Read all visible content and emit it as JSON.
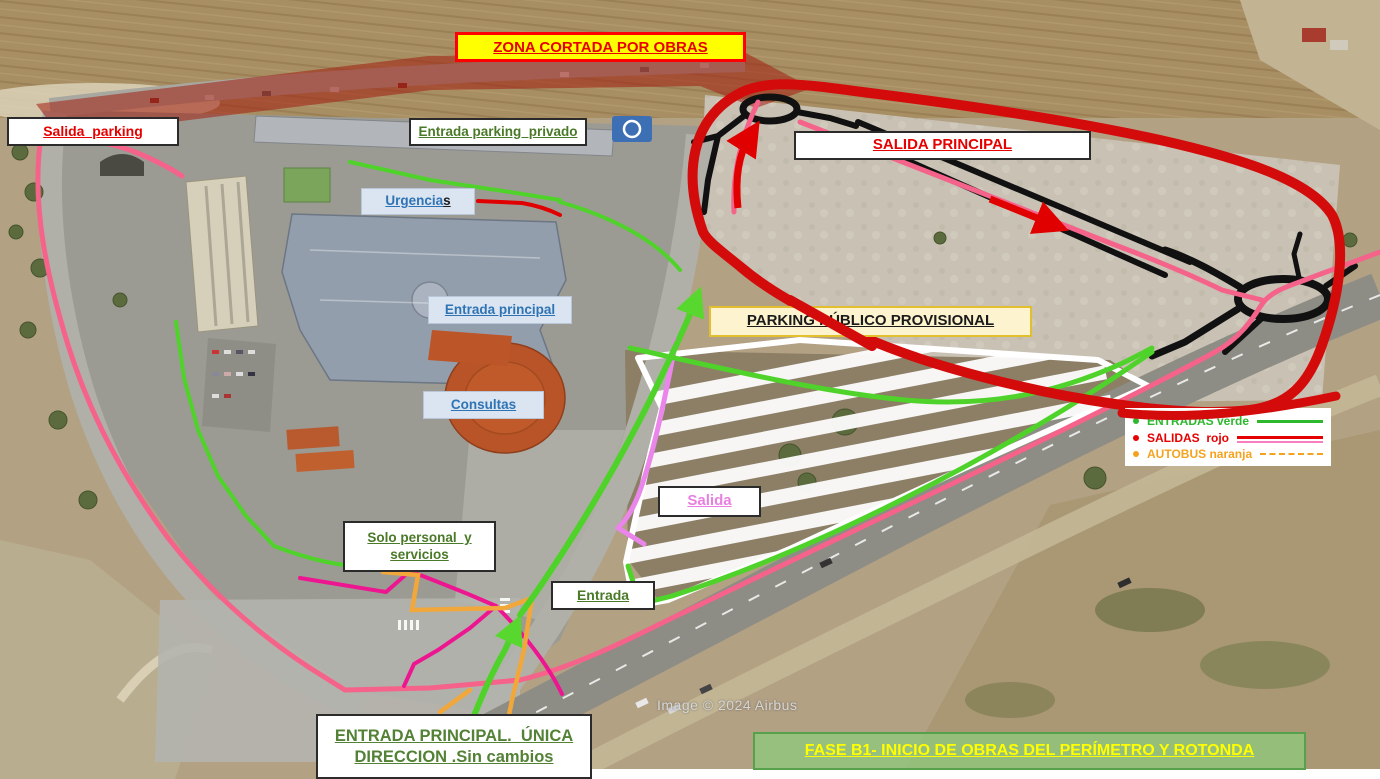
{
  "banners": {
    "zona_cortada": "ZONA CORTADA POR OBRAS",
    "fase_b1": "FASE B1- INICIO DE OBRAS DEL PERÍMETRO Y ROTONDA"
  },
  "labels": {
    "salida_parking": "Salida  parking",
    "entrada_parking_privado": "Entrada parking  privado",
    "urgencias_main": "Urgencia",
    "urgencias_suffix": "s",
    "salida_principal": "SALIDA PRINCIPAL",
    "entrada_principal": "Entrada principal",
    "parking_publico_provisional": "PARKING PÚBLICO PROVISIONAL",
    "consultas": "Consultas",
    "salida_provisional": "Salida",
    "solo_personal_line1": "Solo personal  y",
    "solo_personal_line2": "servicios",
    "entrada_provisional": "Entrada",
    "entrada_principal_unica_line1": "ENTRADA PRINCIPAL.  ÚNICA",
    "entrada_principal_unica_line2": "DIRECCION .Sin cambios"
  },
  "legend": {
    "items": [
      {
        "label": "ENTRADAS verde",
        "color": "#2eb82e",
        "line_style": "solid"
      },
      {
        "label": "SALIDAS  rojo",
        "color": "#e60000",
        "line_style": "solid-with-pink"
      },
      {
        "label": "AUTOBUS naranja",
        "color": "#f5a31f",
        "line_style": "dashed"
      }
    ]
  },
  "watermark": "Image © 2024 Airbus",
  "colors": {
    "entrada_route_green": "#4fd32a",
    "salida_route_red": "#d40b0b",
    "salida_route_pink": "#f5638a",
    "autobus_route_orange": "#f2a73b",
    "salida_provisional_violet": "#ea86ea",
    "magenta_route": "#ee1590",
    "closed_zone_red": "#a21d10"
  }
}
